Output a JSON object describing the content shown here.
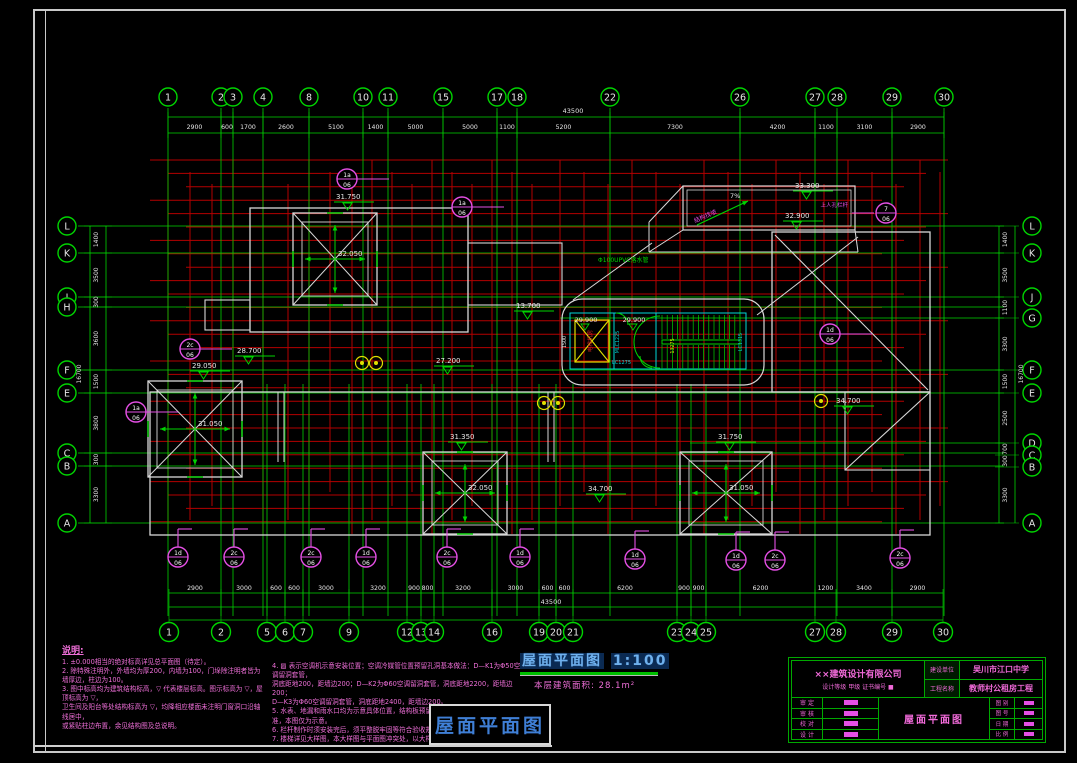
{
  "title": {
    "main": "屋面平面图",
    "scale": "1:100",
    "area_label": "本层建筑面积: 28.1m²",
    "bottom_tag": "屋面平面图"
  },
  "axes": {
    "top": {
      "total": "43500",
      "bubbles": [
        [
          "1",
          168
        ],
        [
          "2",
          221
        ],
        [
          "3",
          233
        ],
        [
          "4",
          263
        ],
        [
          "8",
          309
        ],
        [
          "10",
          363
        ],
        [
          "11",
          388
        ],
        [
          "15",
          443
        ],
        [
          "17",
          497
        ],
        [
          "18",
          517
        ],
        [
          "22",
          610
        ],
        [
          "26",
          740
        ],
        [
          "27",
          815
        ],
        [
          "28",
          837
        ],
        [
          "29",
          892
        ],
        [
          "30",
          944
        ]
      ],
      "dims": [
        "2900",
        "600",
        "1700",
        "2600",
        "5100",
        "1400",
        "5000",
        "5000",
        "1100",
        "5200",
        "7300",
        "4200",
        "1100",
        "3100",
        "2900"
      ]
    },
    "bottom": {
      "total": "43500",
      "bubbles": [
        [
          "1",
          169
        ],
        [
          "2",
          221
        ],
        [
          "5",
          267
        ],
        [
          "6",
          285
        ],
        [
          "7",
          303
        ],
        [
          "9",
          349
        ],
        [
          "12",
          407
        ],
        [
          "13",
          421
        ],
        [
          "14",
          434
        ],
        [
          "16",
          492
        ],
        [
          "19",
          539
        ],
        [
          "20",
          556
        ],
        [
          "21",
          573
        ],
        [
          "23",
          677
        ],
        [
          "24",
          691
        ],
        [
          "25",
          706
        ],
        [
          "27",
          815
        ],
        [
          "28",
          836
        ],
        [
          "29",
          892
        ],
        [
          "30",
          943
        ]
      ],
      "dims": [
        "2900",
        "3000",
        "600",
        "600",
        "3000",
        "3200",
        "900",
        "800",
        "3200",
        "3000",
        "600",
        "600",
        "6200",
        "900",
        "900",
        "6200",
        "1200",
        "3400",
        "2900"
      ]
    },
    "left": {
      "total": "16700",
      "bubbles": [
        [
          "L",
          226
        ],
        [
          "K",
          253
        ],
        [
          "J",
          297
        ],
        [
          "H",
          307
        ],
        [
          "F",
          370
        ],
        [
          "E",
          393
        ],
        [
          "C",
          453
        ],
        [
          "B",
          466
        ],
        [
          "A",
          523
        ]
      ],
      "dims": [
        "1400",
        "3500",
        "300",
        "3600",
        "1500",
        "3800",
        "300",
        "3300"
      ]
    },
    "right": {
      "total": "16700",
      "bubbles": [
        [
          "L",
          226
        ],
        [
          "K",
          253
        ],
        [
          "J",
          297
        ],
        [
          "G",
          318
        ],
        [
          "F",
          370
        ],
        [
          "E",
          393
        ],
        [
          "D",
          443
        ],
        [
          "C",
          455
        ],
        [
          "B",
          467
        ],
        [
          "A",
          523
        ]
      ],
      "dims": [
        "1400",
        "3500",
        "1100",
        "3300",
        "1500",
        "2500",
        "700",
        "300",
        "3300"
      ]
    }
  },
  "pyramids": [
    {
      "ridge": "32.050",
      "marker": "31.750",
      "x": 293,
      "y": 213,
      "w": 84,
      "h": 92,
      "mx": 336,
      "my": 199
    },
    {
      "ridge": "31.050",
      "marker": "29.050",
      "x": 148,
      "y": 381,
      "w": 94,
      "h": 96,
      "mx": 192,
      "my": 368
    },
    {
      "ridge": "32.050",
      "marker": "31.350",
      "x": 423,
      "y": 452,
      "w": 84,
      "h": 82,
      "mx": 450,
      "my": 439
    },
    {
      "ridge": "31.050",
      "marker": "31.750",
      "x": 680,
      "y": 452,
      "w": 92,
      "h": 82,
      "mx": 718,
      "my": 439
    }
  ],
  "elevations": [
    {
      "v": "28.700",
      "x": 237,
      "y": 353
    },
    {
      "v": "27.200",
      "x": 436,
      "y": 363
    },
    {
      "v": "13.700",
      "x": 516,
      "y": 308
    },
    {
      "v": "34.700",
      "x": 588,
      "y": 491
    },
    {
      "v": "34.700",
      "x": 836,
      "y": 403
    }
  ],
  "machine_room": {
    "elev_top": "33.300",
    "elev_mid": "32.900",
    "slope": "7%",
    "slope_note": "结构找坡",
    "pipe_note": "Φ100UPVC落水管",
    "leader_note": "上人孔栏杆",
    "bubble_top": "7",
    "bubble_bot": "06"
  },
  "core": {
    "elev_a": "29.900",
    "elev_b": "29.900",
    "room": "电梯机房",
    "left_dim": "1500",
    "door_a": "MLC1225",
    "door_b": "LC1275",
    "win": "LC1315",
    "stair_dim": "13275"
  },
  "detail_bubbles": [
    {
      "t": "1a",
      "b": "06",
      "x": 347,
      "y": 179
    },
    {
      "t": "1a",
      "b": "06",
      "x": 462,
      "y": 207
    },
    {
      "t": "2c",
      "b": "06",
      "x": 190,
      "y": 349
    },
    {
      "t": "1a",
      "b": "06",
      "x": 136,
      "y": 412
    },
    {
      "t": "1d",
      "b": "06",
      "x": 830,
      "y": 334
    },
    {
      "t": "1d",
      "b": "06",
      "x": 178,
      "y": 557
    },
    {
      "t": "2c",
      "b": "06",
      "x": 234,
      "y": 557
    },
    {
      "t": "2c",
      "b": "06",
      "x": 311,
      "y": 557
    },
    {
      "t": "1d",
      "b": "06",
      "x": 366,
      "y": 557
    },
    {
      "t": "2c",
      "b": "06",
      "x": 447,
      "y": 557
    },
    {
      "t": "1d",
      "b": "06",
      "x": 520,
      "y": 557
    },
    {
      "t": "1d",
      "b": "06",
      "x": 635,
      "y": 559
    },
    {
      "t": "1d",
      "b": "06",
      "x": 736,
      "y": 560
    },
    {
      "t": "2c",
      "b": "06",
      "x": 775,
      "y": 560
    },
    {
      "t": "2c",
      "b": "06",
      "x": 900,
      "y": 558
    }
  ],
  "notes": {
    "heading": "说明:",
    "left": [
      "1. ±0.000相当的绝对标高详见总平面图（待定）。",
      "2. 除特殊注明外，外墙均为厚200，内墙为100，门垛除注明者皆为墙厚边，柱边为100。",
      "3. 图中标高均为建筑结构标高，▽ 代表楼层标高。图示标高为 ▽，屋顶标高为 ▽，",
      "   卫生间及阳台等处结构标高为 ▽，均降相应楼面未注明门窗洞口沿轴线居中，",
      "   或紧贴柱边布置，余见结构图及总说明。"
    ],
    "right": [
      "4. ▨ 表示空调机示意安装位置；空调冷媒管位置预留孔洞基本做法：D—K1为Φ50空调留洞套管，",
      "   洞底距地200，距墙边200；D—K2为Φ60空调留洞套管，洞底距地2200，距墙边200；",
      "   D—K3为Φ60空调留洞套管，洞底距地2400，距墙边200。",
      "5. 水表、地漏和雨水口均为示意具体位置，结构板预留上接水管以给排水专业图纸为准，本图仅为示意。",
      "6. 栏杆制作时须安装完后，须平整脱牢固等符合验收规范。",
      "7. 楼梯详见大样图，本大样图与平面图冲突处，以大样为准，楼内扶手详见图集。"
    ]
  },
  "titleblock": {
    "company": "××建筑设计有限公司",
    "company_sub": "设计等级 甲级  证书编号 ■",
    "client_label": "建设单位",
    "client": "吴川市江口中学",
    "project_label": "工程名称",
    "project": "教师村公租房工程",
    "drawing_title": "屋面平面图",
    "sig_labels": [
      "审 定",
      "审 核",
      "校 对",
      "设 计"
    ],
    "meta_labels": [
      "图 别",
      "图 号",
      "日 期",
      "比 例"
    ]
  },
  "colors": {
    "axis_green": "#00d400",
    "wall_red": "#b40000",
    "outline_white": "#d8d8d8",
    "detail_magenta": "#e44fe4",
    "core_cyan": "#00d8d8",
    "shaft_yellow": "#e0e000",
    "title_blue": "#3f7fd6",
    "note_pink": "#ef6fd8"
  }
}
